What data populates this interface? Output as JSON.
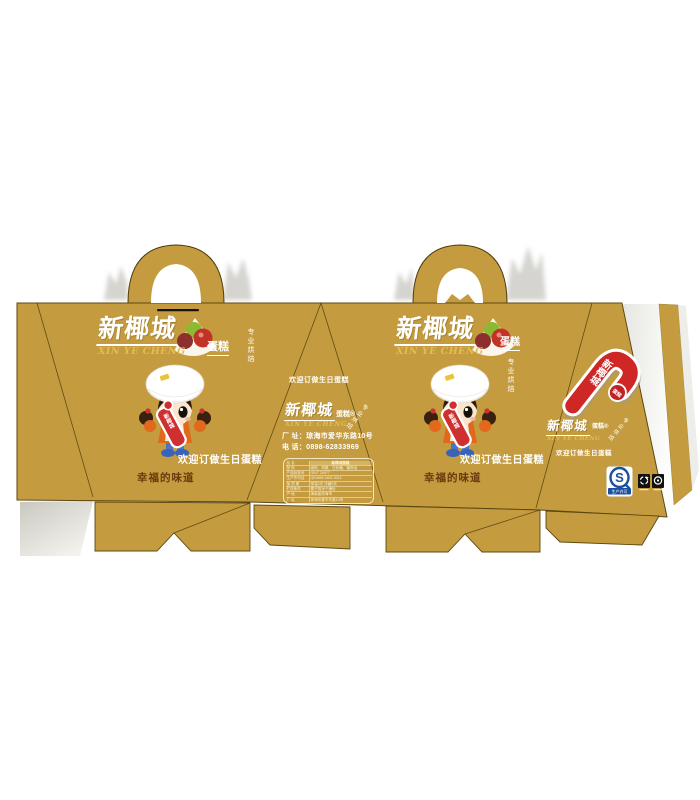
{
  "brand": {
    "name_cn": "新椰城",
    "name_en": "XIN YE CHENG",
    "product": "蛋糕",
    "product_registered": "蛋糕®",
    "tagline_vertical": "专业烘焙"
  },
  "slogans": {
    "welcome": "欢迎订做生日蛋糕",
    "taste": "幸福的味道"
  },
  "contact": {
    "address": "厂 址：琼海市爱华东路10号",
    "phone": "电 话：0898-62833969"
  },
  "info_table": {
    "rows": [
      {
        "label": "品  名",
        "value": "新椰城蛋糕"
      },
      {
        "label": "配  料",
        "value": "面粉、鸡蛋、白砂糖、植物油"
      },
      {
        "label": "产品标准号",
        "value": "GB/T 20977"
      },
      {
        "label": "生产许可证",
        "value": "QS4690 2401 0012"
      },
      {
        "label": "保 质 期",
        "value": "常温3天 冷藏5天"
      },
      {
        "label": "贮存条件",
        "value": "置于阴凉干燥处"
      },
      {
        "label": "产  地",
        "value": "海南省琼海市"
      },
      {
        "label": "厂  址",
        "value": "琼海市爱华东路10号"
      }
    ]
  },
  "marks": {
    "cane_text": "新椰城",
    "cane_badge": "蛋糕",
    "girl_sign": "新椰城",
    "qs_letter": "S",
    "qs_caption": "生产许可"
  },
  "colors": {
    "box_gold": "#C49B3E",
    "logo_gold": "#E3BD52",
    "accent_red": "#CF2F2F",
    "qs_blue": "#1C4FA0",
    "taste_brown": "#6A3A0E"
  }
}
